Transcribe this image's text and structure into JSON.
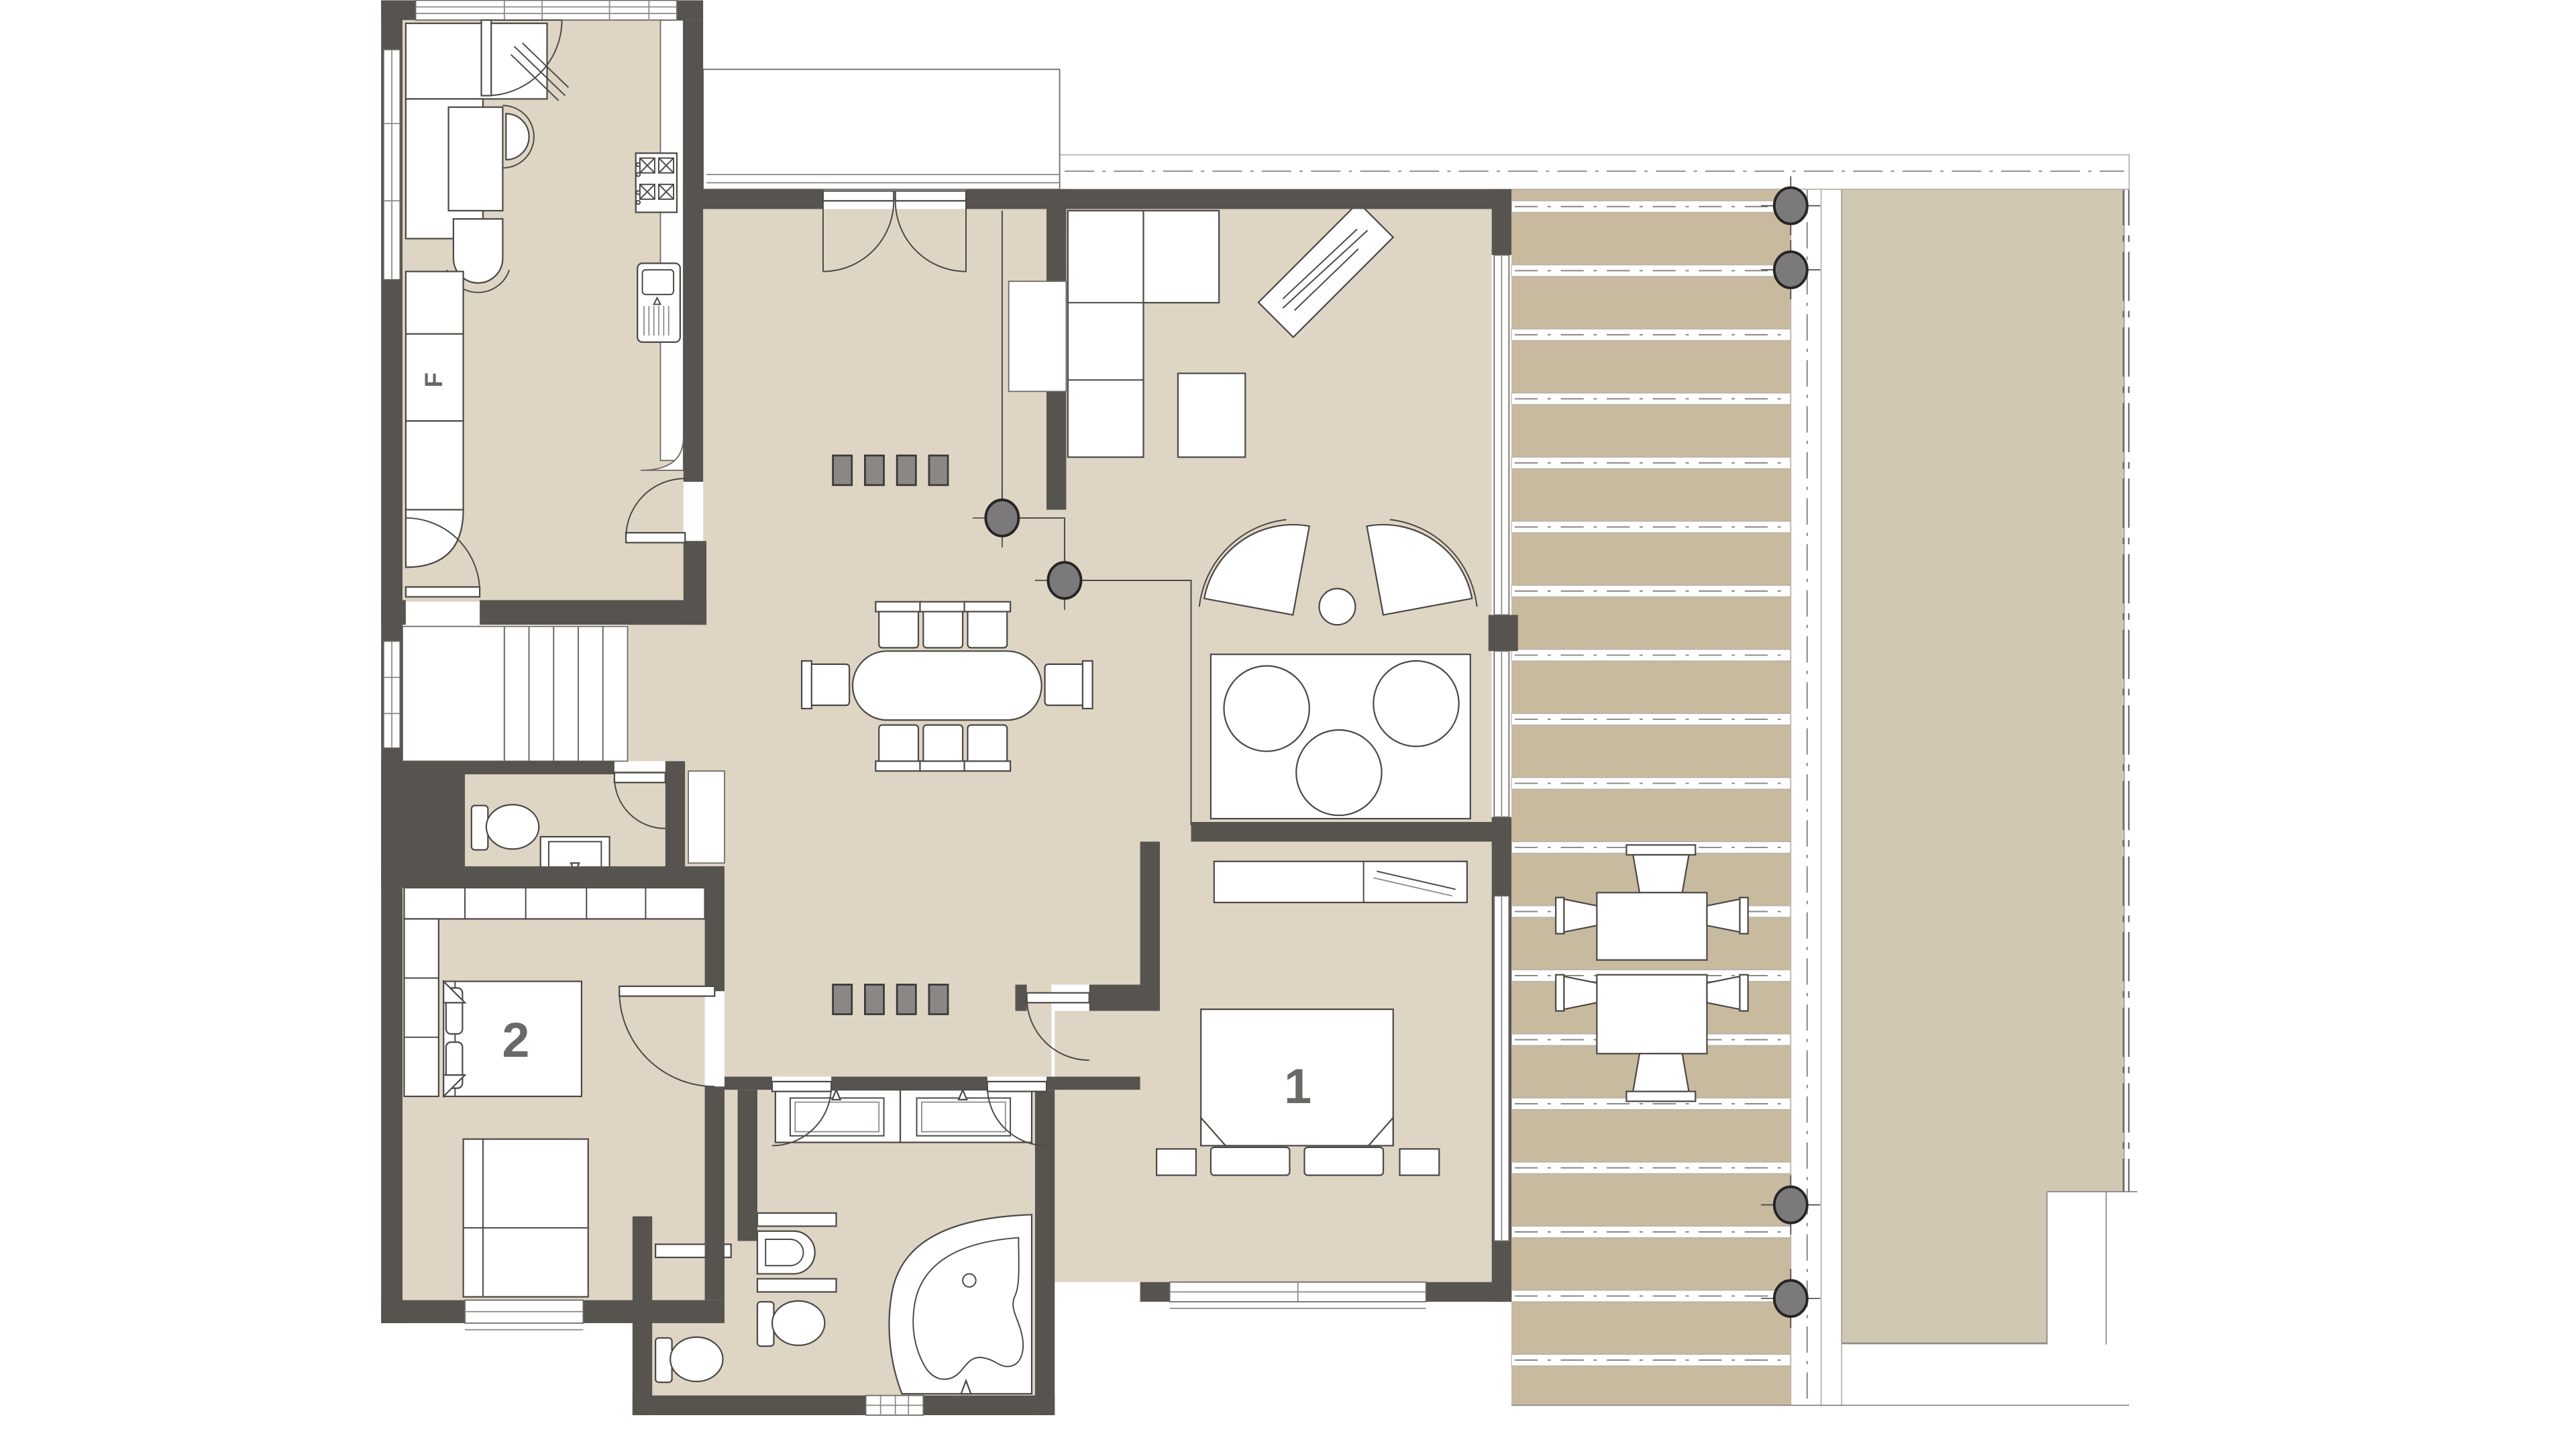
{
  "plan": {
    "type": "residential-floor-plan",
    "rooms": {
      "kitchen": {
        "fridge_label": "F",
        "features": [
          "counter",
          "desk",
          "chairs",
          "stove-4-burner",
          "sink-with-drainboard",
          "fridge",
          "plant",
          "garden-door"
        ]
      },
      "living_room": {
        "features": [
          "l-shaped-sofa",
          "coffee-table",
          "diagonal-console-with-plant",
          "two-fan-armchairs",
          "round-side-table",
          "rug-with-three-round-tables",
          "glazed-east-wall"
        ]
      },
      "dining_hall": {
        "features": [
          "oval-table",
          "eight-chairs",
          "entry-double-door",
          "wall-niche",
          "floor-markers"
        ]
      },
      "bedroom_1": {
        "label": "1",
        "features": [
          "double-bed",
          "two-pillows",
          "two-nightstands",
          "wardrobe-with-rail",
          "window-south",
          "window-east"
        ]
      },
      "bedroom_2": {
        "label": "2",
        "features": [
          "double-bed",
          "two-pillows",
          "wardrobe-top-row",
          "wardrobe-left-column",
          "daybed",
          "window-south"
        ]
      },
      "bathroom": {
        "features": [
          "double-vanity-with-mirrors",
          "shelves",
          "bidet",
          "toilet",
          "corner-bathtub",
          "toilet-stall",
          "window-south"
        ]
      },
      "wc": {
        "features": [
          "toilet",
          "washbasin",
          "door"
        ]
      },
      "stairs": {
        "tread_count": 5
      },
      "deck": {
        "plank_gap_count": 19,
        "columns": 4,
        "outdoor_tables": 2,
        "outdoor_chairs": 6
      },
      "lawn": {
        "fence": "east-double-line",
        "corner_notch": "south-east"
      }
    },
    "labels": {
      "bedroom1": "1",
      "bedroom2": "2",
      "fridge": "F"
    },
    "markers": {
      "hall_gray_squares": 8,
      "structural_columns_hall": 2,
      "structural_columns_deck": 4
    },
    "colors": {
      "wall": "#57534f",
      "floor": "#ded5c4",
      "deck_plank": "#c8ba9f",
      "lawn": "#d1c8b3",
      "marker_gray": "#8a8786",
      "column_gray": "#7c797a",
      "line": "#4b4846",
      "label": "#6b6866",
      "background": "#ffffff"
    }
  }
}
